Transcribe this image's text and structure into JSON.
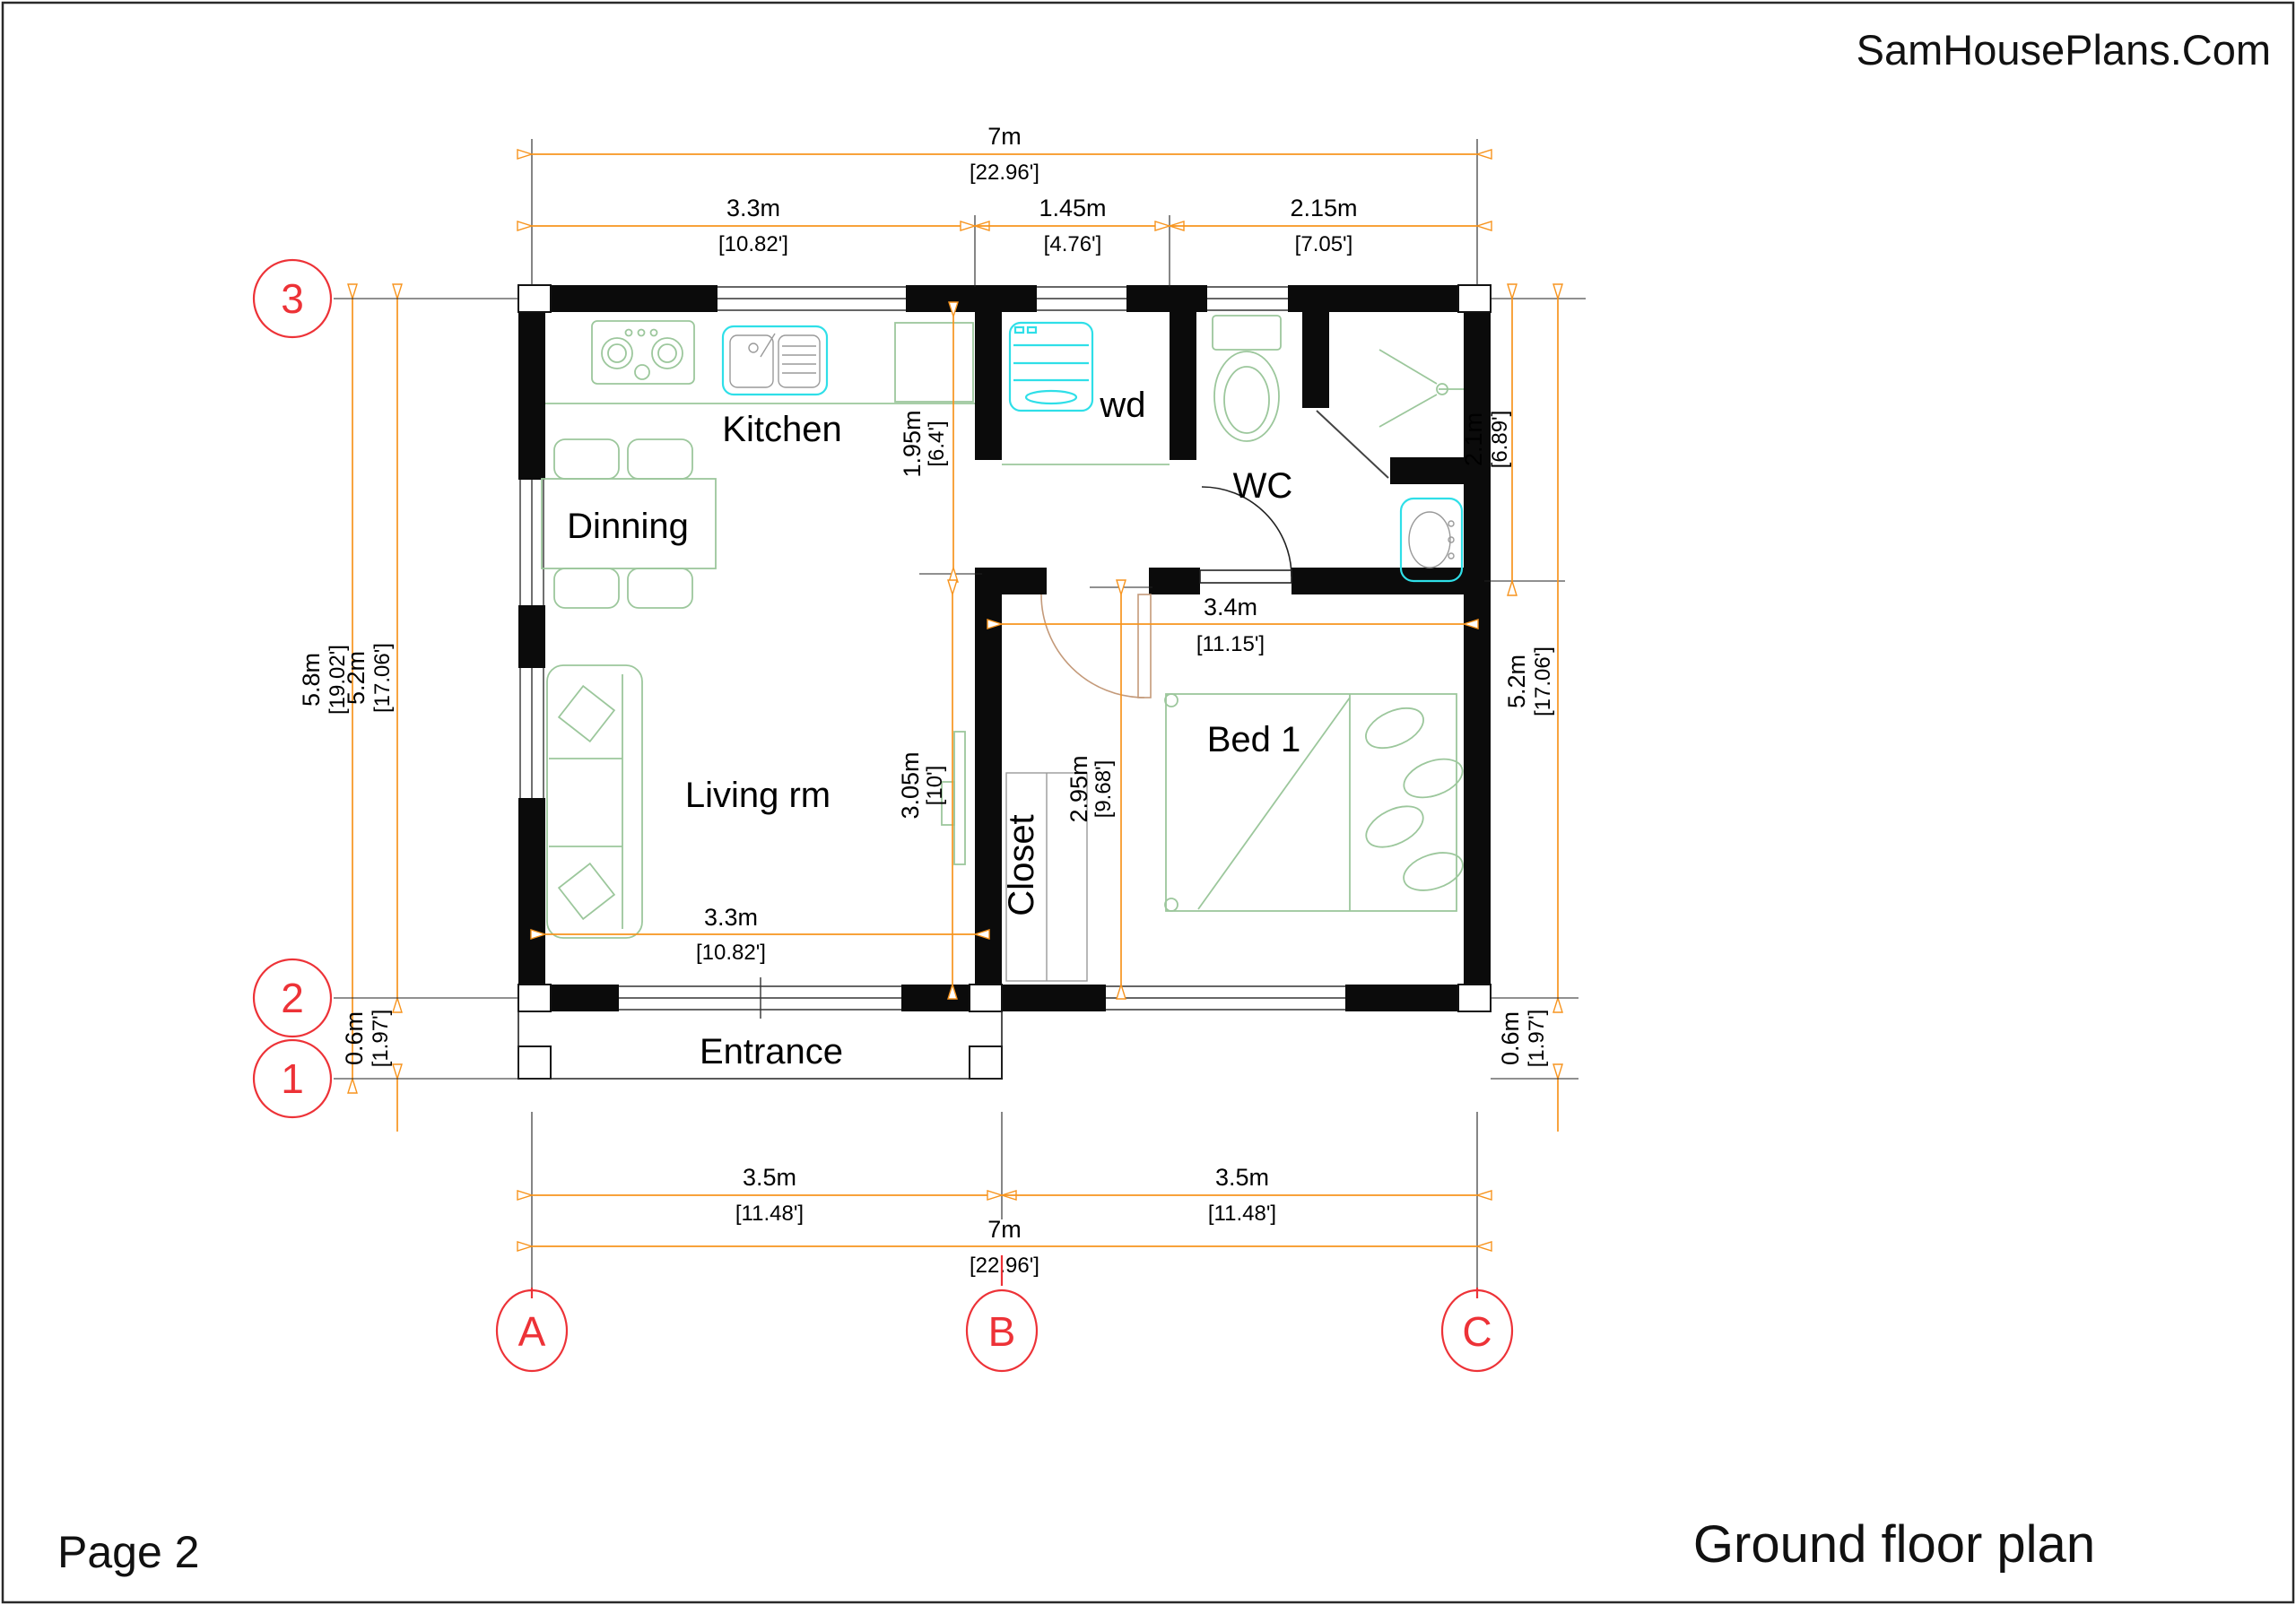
{
  "header": {
    "site": "SamHousePlans.Com"
  },
  "footer": {
    "page": "Page 2",
    "plan_title": "Ground floor plan"
  },
  "rooms": {
    "kitchen": "Kitchen",
    "dinning": "Dinning",
    "living": "Living rm",
    "closet": "Closet",
    "bed1": "Bed 1",
    "wd": "wd",
    "wc": "WC",
    "entrance": "Entrance"
  },
  "grid": {
    "rows": [
      "3",
      "2",
      "1"
    ],
    "cols": [
      "A",
      "B",
      "C"
    ]
  },
  "dims": {
    "top_total": {
      "m": "7m",
      "ft": "[22.96']"
    },
    "top_kitchen": {
      "m": "3.3m",
      "ft": "[10.82']"
    },
    "top_wd": {
      "m": "1.45m",
      "ft": "[4.76']"
    },
    "top_wc": {
      "m": "2.15m",
      "ft": "[7.05']"
    },
    "left_total": {
      "m": "5.8m",
      "ft": "[19.02']"
    },
    "left_inner": {
      "m": "5.2m",
      "ft": "[17.06']"
    },
    "left_porch": {
      "m": "0.6m",
      "ft": "[1.97']"
    },
    "right_wc": {
      "m": "2.1m",
      "ft": "[6.89']"
    },
    "right_inner": {
      "m": "5.2m",
      "ft": "[17.06']"
    },
    "right_porch": {
      "m": "0.6m",
      "ft": "[1.97']"
    },
    "kitchen_depth": {
      "m": "1.95m",
      "ft": "[6.4']"
    },
    "living_depth": {
      "m": "3.05m",
      "ft": "[10']"
    },
    "living_width": {
      "m": "3.3m",
      "ft": "[10.82']"
    },
    "bed_width": {
      "m": "3.4m",
      "ft": "[11.15']"
    },
    "bed_depth": {
      "m": "2.95m",
      "ft": "[9.68']"
    },
    "bottom_left": {
      "m": "3.5m",
      "ft": "[11.48']"
    },
    "bottom_right": {
      "m": "3.5m",
      "ft": "[11.48']"
    },
    "bottom_total": {
      "m": "7m",
      "ft": "[22.96']"
    }
  },
  "colors": {
    "dimension_orange": "#f7941e",
    "grid_red": "#ed3237",
    "furniture_green": "#9cc79c",
    "fixture_cyan": "#2fdfe8",
    "door_tan": "#c49a7a",
    "wall_black": "#0b0b0b"
  }
}
